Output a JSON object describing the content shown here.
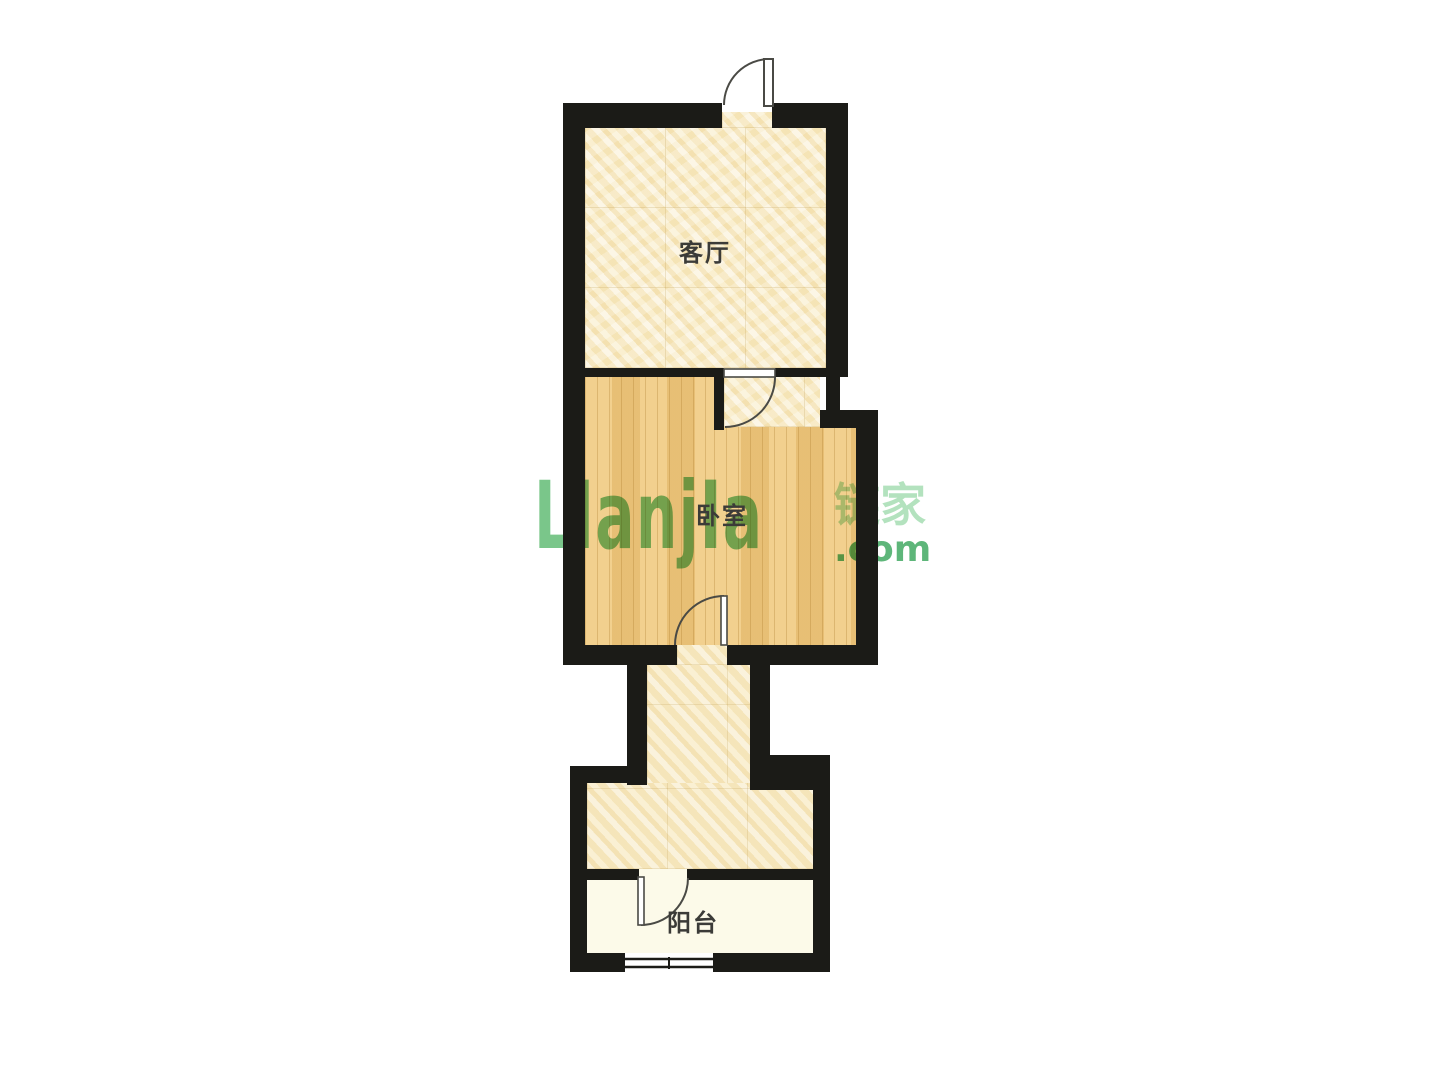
{
  "floorplan": {
    "rooms": {
      "living_room": {
        "label": "客厅"
      },
      "bedroom": {
        "label": "卧室"
      },
      "balcony": {
        "label": "阳台"
      }
    },
    "watermark": {
      "logo": "LIanjIa",
      "brand": "链家",
      "tld": ".com"
    },
    "colors": {
      "wall": "#1b1b17",
      "tile": "#f7eac3",
      "wood": "#f0c97e",
      "balcony_floor": "#fcfae9",
      "watermark_green": "#58b86c",
      "label_text": "#3b3b38"
    }
  }
}
